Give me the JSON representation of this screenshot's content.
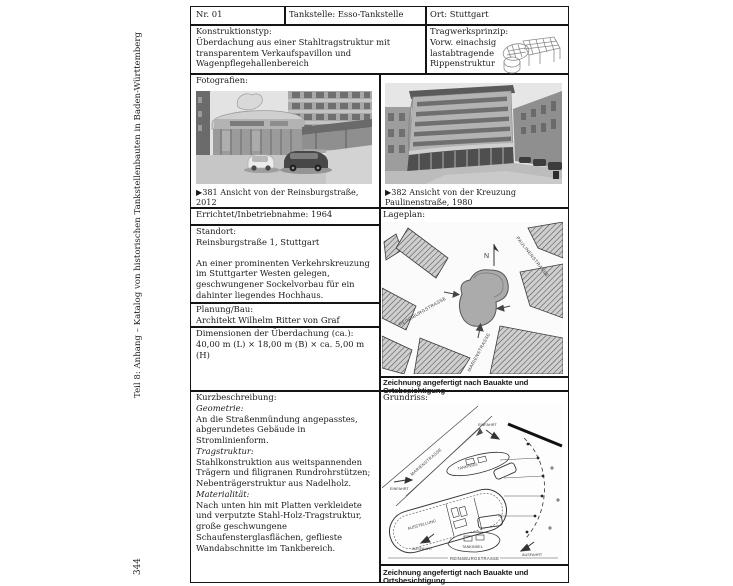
{
  "page": {
    "sidebar_text": "Teil 8: Anhang – Katalog von historischen Tankstellenbauten in Baden-Württemberg",
    "page_number": "344"
  },
  "header": {
    "nr": "Nr. 01",
    "tankstelle": "Tankstelle: Esso-Tankstelle",
    "ort": "Ort: Stuttgart"
  },
  "konstruktion": {
    "label": "Konstruktionstyp:",
    "text": "Überdachung aus einer Stahltragstruktur mit transparentem Verkaufspavillon und Wagenpflegehallenbereich"
  },
  "tragwerk": {
    "label": "Tragwerksprinzip:",
    "line1": "Vorw. einachsig",
    "line2": "lastabtragende",
    "line3": "Rippenstruktur"
  },
  "fotografien": {
    "label": "Fotografien:",
    "caption_left": "▶381 Ansicht von der Reinsburgstraße, 2012",
    "caption_right": "▶382 Ansicht von der Kreuzung Paulinenstraße, 1980"
  },
  "errichtet": {
    "text": "Errichtet/Inbetriebnahme: 1964"
  },
  "standort": {
    "label": "Standort:",
    "address": "Reinsburgstraße 1, Stuttgart",
    "description": "An einer prominenten Verkehrskreuzung im Stuttgarter Westen gelegen, geschwungener Sockelvorbau für ein dahinter liegendes Hochhaus."
  },
  "planung": {
    "label": "Planung/Bau:",
    "text": "Architekt Wilhelm Ritter von Graf"
  },
  "dimensionen": {
    "label": "Dimensionen der Überdachung (ca.):",
    "text": "40,00 m (L) × 18,00 m (B) × ca. 5,00 m (H)"
  },
  "lageplan": {
    "label": "Lageplan:",
    "caption": "Zeichnung angefertigt nach Bauakte und Ortsbesichtigung",
    "north": "N",
    "streets": {
      "paulinen": "PAULINENSTRASSE",
      "reinsburg": "REINSBURGSTRASSE",
      "marien": "MARIENSTRASSE"
    }
  },
  "kurzbeschreibung": {
    "label": "Kurzbeschreibung:",
    "geometrie_label": "Geometrie:",
    "geometrie": "An die Straßenmündung angepasstes, abgerundetes Gebäude in Stromlinienform.",
    "tragstruktur_label": "Tragstruktur:",
    "tragstruktur": "Stahlkonstruktion aus weitspannenden Trägern und filigranen Rundrohrstützen; Nebenträgerstruktur aus Nadelholz.",
    "materialitaet_label": "Materialität:",
    "materialitaet": "Nach unten hin mit Platten verkleidete und verputzte Stahl-Holz-Tragstruktur, große geschwungene Schaufensterglasflächen, geflieste Wandabschnitte im Tankbereich."
  },
  "grundriss": {
    "label": "Grundriss:",
    "caption": "Zeichnung angefertigt nach Bauakte und Ortsbesichtigung",
    "labels": {
      "tankinsel": "TANKINSEL",
      "einfahrt": "EINFAHRT",
      "ausfahrt": "AUSFAHRT",
      "ausstellung": "AUSSTELLUNG",
      "reinsburg": "REINSBURGSTRASSE",
      "marien": "MARIENSTRASSE"
    }
  }
}
